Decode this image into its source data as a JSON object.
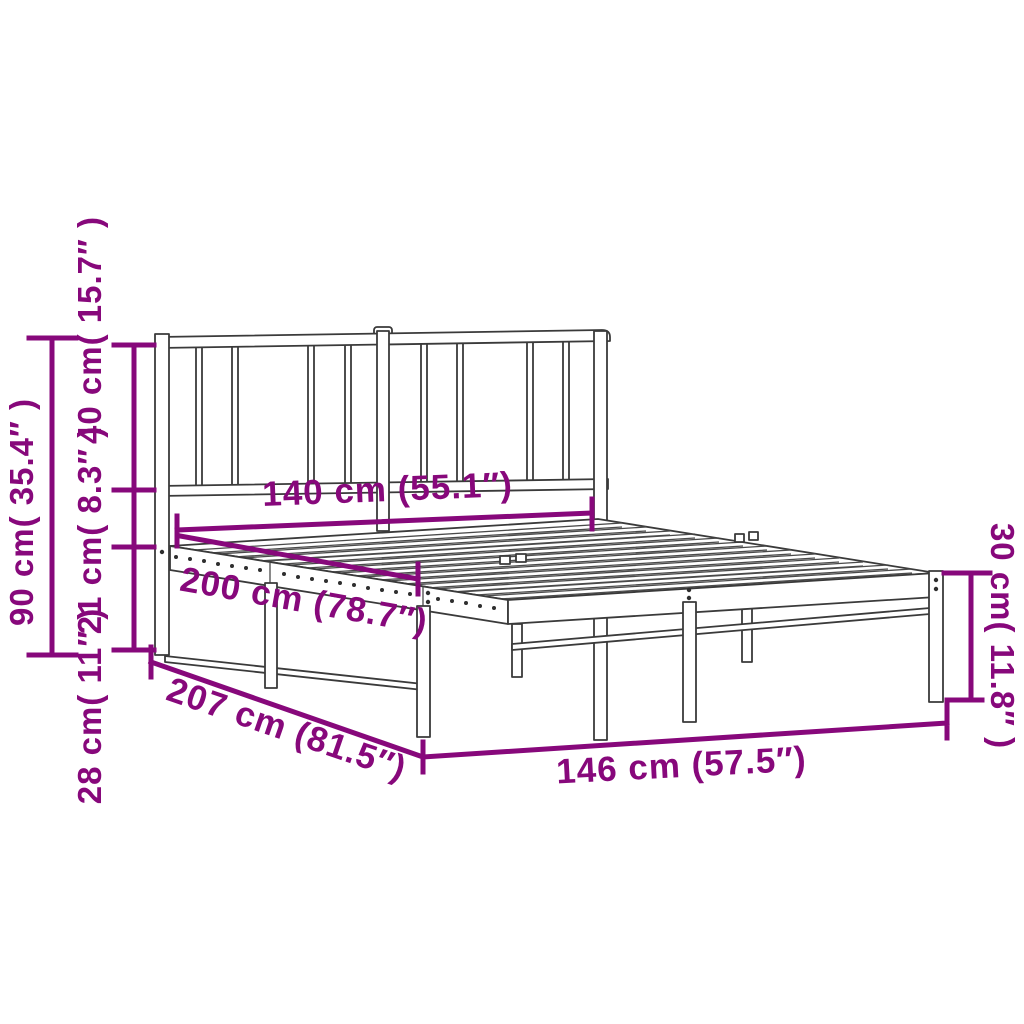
{
  "diagram": {
    "subject": "Metal bed frame with headboard — product dimension drawing",
    "accent_color": "#87087B",
    "line_color": "#3A3A3A",
    "dimensions": {
      "headboard_width": "140 cm (55.1″)",
      "sleeping_length": "200 cm (78.7″)",
      "total_length": "207 cm (81.5″)",
      "total_width": "146 cm (57.5″)",
      "headboard_height": "90 cm( 35.4″ )",
      "headboard_panel_height": "40 cm( 15.7″ )",
      "panel_to_platform": "21 cm( 8.3″ )",
      "underbed_clearance": "28 cm( 11″ )",
      "platform_height": "30 cm( 11.8″ )"
    }
  }
}
